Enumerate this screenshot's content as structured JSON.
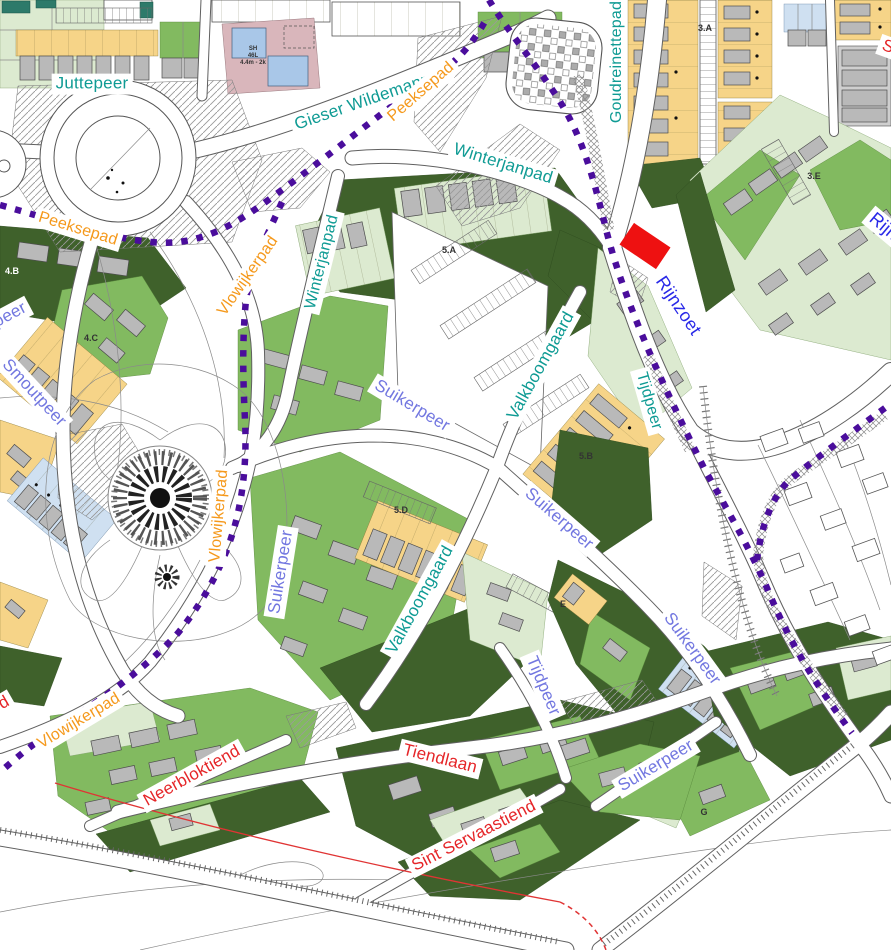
{
  "map": {
    "palette": {
      "teal": "#0f9b94",
      "orange": "#f5991c",
      "blue": "#2929e8",
      "periwinkle": "#7277e0",
      "red": "#e52528",
      "zone": "#333333",
      "zone_light": "#ffffff",
      "path_dots": "#4a0d9c"
    },
    "highlight": {
      "color": "#ee1111"
    },
    "street_labels": [
      {
        "text": "Juttepeer",
        "color": "teal",
        "x": 92,
        "y": 84,
        "rot": 0,
        "size": 17
      },
      {
        "text": "Gieser Wildemanpad",
        "color": "teal",
        "x": 372,
        "y": 99,
        "rot": -19,
        "size": 17
      },
      {
        "text": "Winterjanpad",
        "color": "teal",
        "x": 503,
        "y": 164,
        "rot": 17,
        "size": 17
      },
      {
        "text": "Goudreinettepad",
        "color": "teal",
        "x": 617,
        "y": 62,
        "rot": -90,
        "size": 16
      },
      {
        "text": "Winterjanpad",
        "color": "teal",
        "x": 322,
        "y": 262,
        "rot": -76,
        "size": 16
      },
      {
        "text": "Valkboomgaard",
        "color": "teal",
        "x": 541,
        "y": 366,
        "rot": -61,
        "size": 17
      },
      {
        "text": "Valkboomgaard",
        "color": "teal",
        "x": 420,
        "y": 600,
        "rot": -61,
        "size": 17
      },
      {
        "text": "Tijdpeer",
        "color": "teal",
        "x": 649,
        "y": 401,
        "rot": 74,
        "size": 16
      },
      {
        "text": "Rijnzoet",
        "color": "blue",
        "x": 678,
        "y": 306,
        "rot": 56,
        "size": 18
      },
      {
        "text": "Rijnzoet",
        "color": "blue",
        "x": 897,
        "y": 238,
        "rot": 40,
        "size": 18
      },
      {
        "text": "Peeksepad",
        "color": "orange",
        "x": 78,
        "y": 229,
        "rot": 17,
        "size": 16
      },
      {
        "text": "Peeksepad",
        "color": "orange",
        "x": 421,
        "y": 92,
        "rot": -41,
        "size": 16
      },
      {
        "text": "Vlowijkerpad",
        "color": "orange",
        "x": 248,
        "y": 276,
        "rot": -55,
        "size": 16
      },
      {
        "text": "Vlowijkerpad",
        "color": "orange",
        "x": 219,
        "y": 516,
        "rot": -85,
        "size": 16
      },
      {
        "text": "Vlowijkerpad",
        "color": "orange",
        "x": 79,
        "y": 721,
        "rot": -31,
        "size": 16
      },
      {
        "text": "peer",
        "color": "periwinkle",
        "x": 10,
        "y": 315,
        "rot": -28,
        "size": 17
      },
      {
        "text": "Smoutpeer",
        "color": "periwinkle",
        "x": 34,
        "y": 393,
        "rot": 47,
        "size": 17
      },
      {
        "text": "Suikerpeer",
        "color": "periwinkle",
        "x": 412,
        "y": 406,
        "rot": 31,
        "size": 17
      },
      {
        "text": "Suikerpeer",
        "color": "periwinkle",
        "x": 281,
        "y": 572,
        "rot": -81,
        "size": 17
      },
      {
        "text": "Suikerpeer",
        "color": "periwinkle",
        "x": 559,
        "y": 519,
        "rot": 41,
        "size": 17
      },
      {
        "text": "Tijdpeer",
        "color": "periwinkle",
        "x": 543,
        "y": 686,
        "rot": 67,
        "size": 17
      },
      {
        "text": "Suikerpeer",
        "color": "periwinkle",
        "x": 692,
        "y": 649,
        "rot": 54,
        "size": 17
      },
      {
        "text": "Suikerpeer",
        "color": "periwinkle",
        "x": 656,
        "y": 766,
        "rot": -31,
        "size": 17
      },
      {
        "text": "Neerbloktiend",
        "color": "red",
        "x": 192,
        "y": 776,
        "rot": -29,
        "size": 17
      },
      {
        "text": "Tiendlaan",
        "color": "red",
        "x": 440,
        "y": 759,
        "rot": 14,
        "size": 17
      },
      {
        "text": "Sint Servaastiend",
        "color": "red",
        "x": 474,
        "y": 836,
        "rot": -27,
        "size": 17
      },
      {
        "text": "S",
        "color": "red",
        "x": 888,
        "y": 47,
        "rot": 20,
        "size": 17
      },
      {
        "text": "d",
        "color": "red",
        "x": 4,
        "y": 703,
        "rot": -30,
        "size": 17
      }
    ],
    "zone_labels": [
      {
        "text": "3.A",
        "x": 705,
        "y": 28,
        "size": 9
      },
      {
        "text": "3.E",
        "x": 814,
        "y": 176,
        "size": 9
      },
      {
        "text": "4.B",
        "x": 12,
        "y": 271,
        "size": 9,
        "light": true
      },
      {
        "text": "4.C",
        "x": 91,
        "y": 338,
        "size": 9
      },
      {
        "text": "5.A",
        "x": 449,
        "y": 250,
        "size": 9
      },
      {
        "text": "5.B",
        "x": 586,
        "y": 456,
        "size": 9
      },
      {
        "text": "5.D",
        "x": 401,
        "y": 510,
        "size": 9
      },
      {
        "text": "E",
        "x": 563,
        "y": 604,
        "size": 9
      },
      {
        "text": "G",
        "x": 704,
        "y": 812,
        "size": 9
      },
      {
        "text": "SH",
        "x": 253,
        "y": 49,
        "size": 6
      },
      {
        "text": "46L",
        "x": 253,
        "y": 56,
        "size": 6
      },
      {
        "text": "4.4m - 2k",
        "x": 253,
        "y": 63,
        "size": 6
      }
    ]
  }
}
